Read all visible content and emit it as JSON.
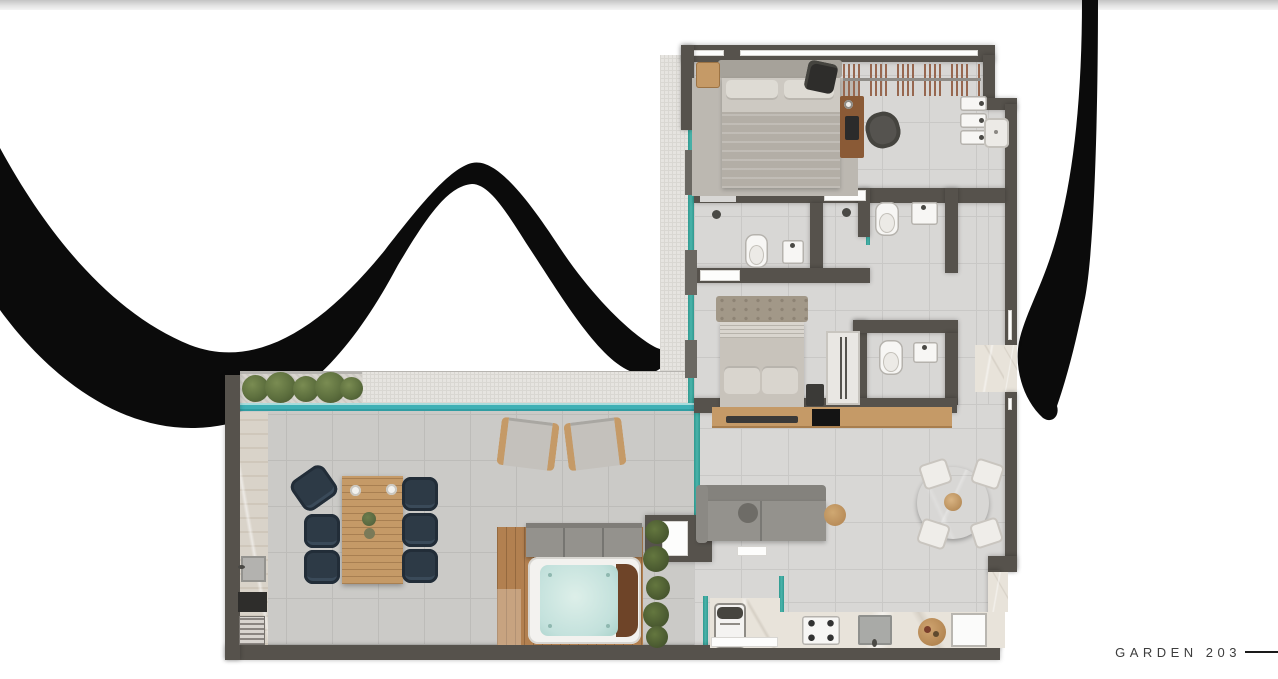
{
  "footer": {
    "label": "GARDEN 203"
  },
  "decor": {
    "left_shape": "wave-brush-stroke",
    "right_shape": "curved-brush-stroke",
    "color": "#0b0b0b"
  },
  "palette": {
    "black": "#0b0b0b",
    "wall": "#56524c",
    "wall-light": "#6b6862",
    "floor": "#d8d7d5",
    "floor-line": "#c9c8c6",
    "terrace-floor": "#cbcac7",
    "terrace-line": "#bdbcb9",
    "pebble": "#e6e4e0",
    "pebble-line": "#d9d7d2",
    "water": "#3fb0b5",
    "water-light": "#a8dcdc",
    "glass": "#4ab3aa",
    "wood": "#c59a67",
    "wood-dark": "#8a5a36",
    "deck": "#b28050",
    "navy": "#2d3a46",
    "sofa": "#94928d",
    "sofa-dark": "#84827d",
    "marble": "#e8e3da",
    "green-marble": "#527e66",
    "spa-water": "#c3e1dc",
    "spa-rim": "#f3f2ef",
    "spa-wood": "#6e4428",
    "plant": "#5d6f3e",
    "plant-dark": "#46552e",
    "linen": "#cdc9c2",
    "blanket": "#b3aea6",
    "rug": "#bcb8b1",
    "white-fixture": "#f7f6f4",
    "fixture-line": "#b5b2ad",
    "closet-stripe": "#97674f",
    "text": "#3d3d3d",
    "line": "#1a1a1a"
  }
}
